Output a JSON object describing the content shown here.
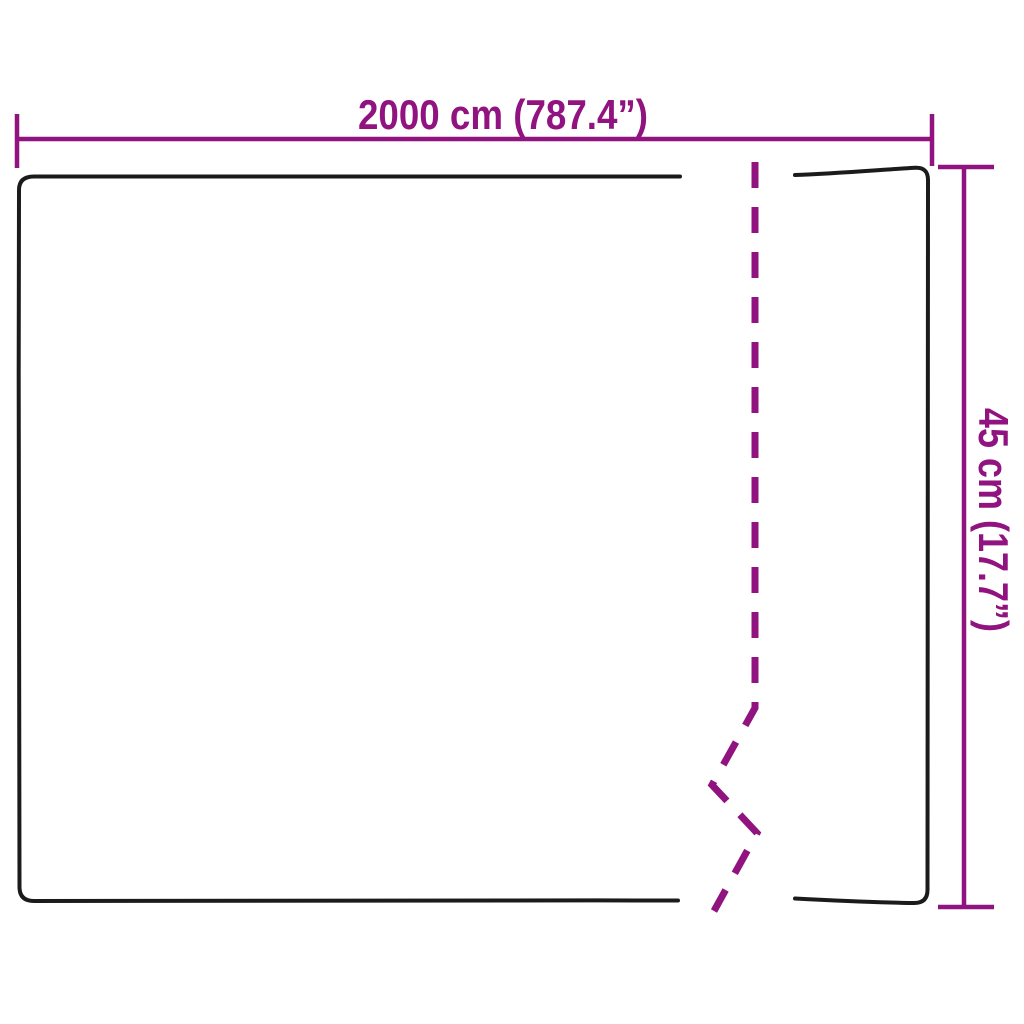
{
  "diagram": {
    "title": "product-dimension-diagram",
    "width_label": "2000 cm (787.4”)",
    "height_label": "45 cm (17.7”)",
    "colors": {
      "dimension": "#90137f",
      "outline": "#1b1b1b",
      "background": "#ffffff"
    }
  }
}
